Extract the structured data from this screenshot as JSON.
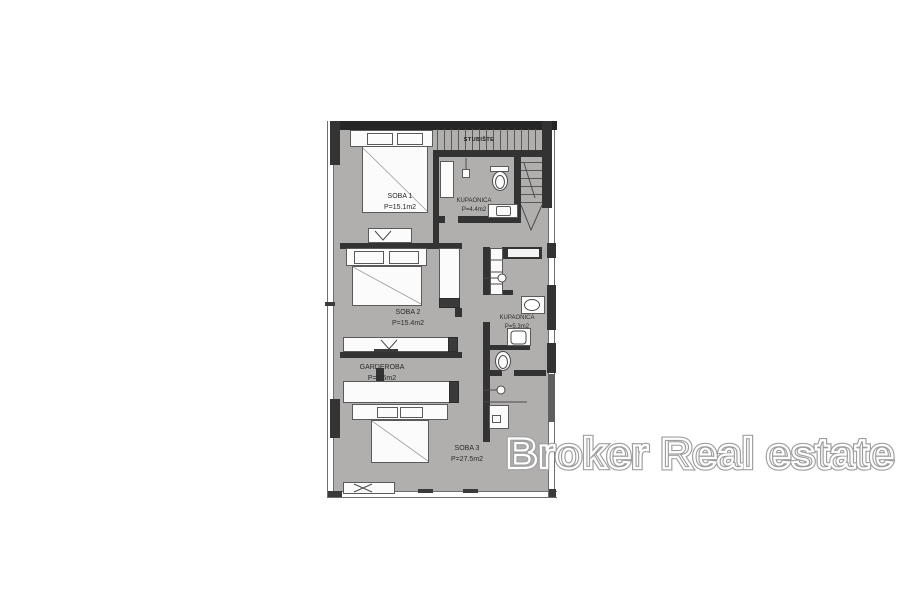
{
  "plan": {
    "rooms": [
      {
        "name": "SOBA 1",
        "area": "P=15.1m2"
      },
      {
        "name": "KUPAONICA",
        "area": "P=4.4m2"
      },
      {
        "name": "SOBA 2",
        "area": "P=15.4m2"
      },
      {
        "name": "KUPAONICA",
        "area": "P=5.3m2"
      },
      {
        "name": "GARDEROBA",
        "area": "P=6.5m2"
      },
      {
        "name": "SOBA 3",
        "area": "P=27.5m2"
      }
    ],
    "staircase_label": "STUBIŠTE"
  },
  "watermark": {
    "text": "Broker Real estate"
  },
  "colors": {
    "floor": "#b1afad",
    "wall": "#333333",
    "watermark_outline": "#9e9e9e",
    "watermark_inner": "#ffffff"
  }
}
